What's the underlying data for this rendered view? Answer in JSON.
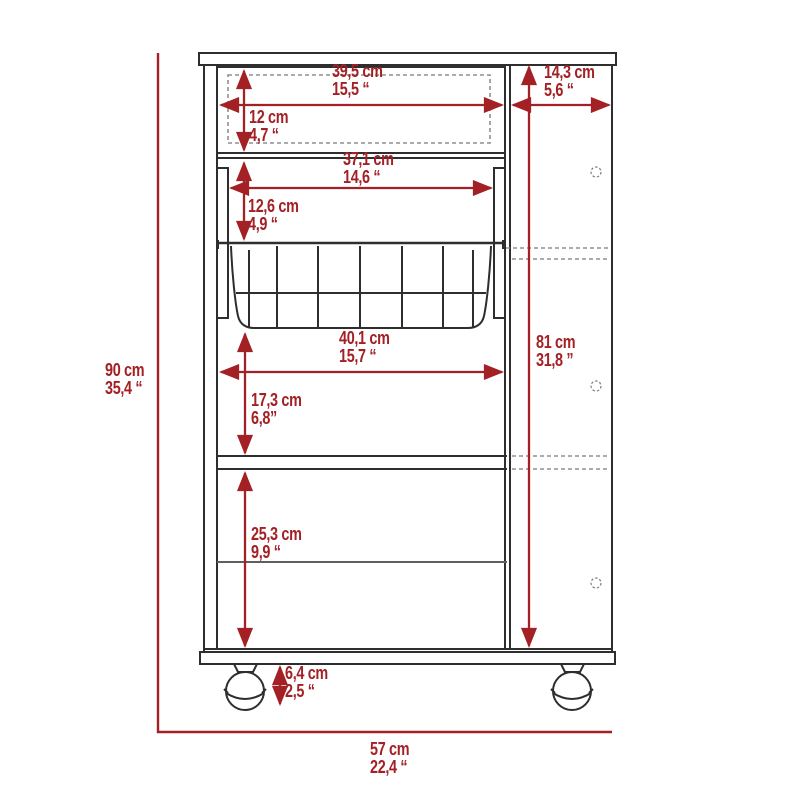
{
  "diagram": {
    "kind": "furniture dimension drawing",
    "subject": "bar cart cabinet with drawer, wire basket, shelves and ball casters",
    "accent_color": "#a32025",
    "line_color": "#2e2e2e",
    "units": "cm / inches"
  },
  "dimensions": {
    "drawer_width": {
      "cm": "39,5 cm",
      "in": "15,5 “"
    },
    "right_panel_depth": {
      "cm": "14,3 cm",
      "in": "5,6 “"
    },
    "drawer_height": {
      "cm": "12 cm",
      "in": "4,7 “"
    },
    "drawer_inner_width": {
      "cm": "37,1 cm",
      "in": "14,6 “"
    },
    "basket_section_height": {
      "cm": "12,6 cm",
      "in": "4,9 “"
    },
    "basket_width": {
      "cm": "40,1 cm",
      "in": "15,7 “"
    },
    "side_panel_height": {
      "cm": "81 cm",
      "in": "31,8 ”"
    },
    "middle_shelf_height": {
      "cm": "17,3 cm",
      "in": "6,8”"
    },
    "lower_compartment_height": {
      "cm": "25,3 cm",
      "in": "9,9 “"
    },
    "caster_height": {
      "cm": "6,4 cm",
      "in": "2,5 “"
    },
    "overall_height": {
      "cm": "90 cm",
      "in": "35,4 “"
    },
    "overall_width": {
      "cm": "57 cm",
      "in": "22,4 “"
    }
  }
}
